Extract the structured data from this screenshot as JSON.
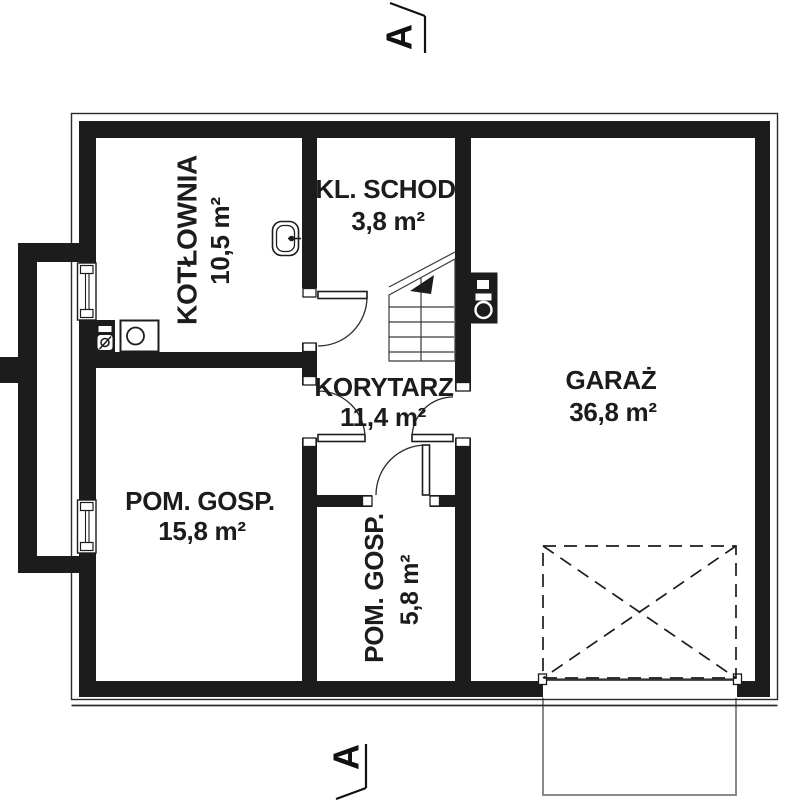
{
  "plan": {
    "type": "floor-plan",
    "section_marker": "A",
    "rooms": {
      "kotlownia": {
        "name": "KOTŁOWNIA",
        "area": "10,5 m²"
      },
      "kl_schod": {
        "name": "KL. SCHOD.",
        "area": "3,8 m²"
      },
      "korytarz": {
        "name": "KORYTARZ",
        "area": "11,4 m²"
      },
      "garaz": {
        "name": "GARAŻ",
        "area": "36,8 m²"
      },
      "pom_gosp_15": {
        "name": "POM. GOSP.",
        "area": "15,8 m²"
      },
      "pom_gosp_5": {
        "name": "POM. GOSP.",
        "area": "5,8 m²"
      }
    },
    "fixtures": [
      "sink",
      "boiler",
      "meter-panel",
      "water-heater",
      "stairs",
      "garage-door",
      "windows",
      "exterior-stairwell",
      "driveway-apron"
    ],
    "colors": {
      "wall": "#1c1c1c",
      "line": "#2b2b2b",
      "apron_outline": "#7d7d7d",
      "background": "#ffffff"
    }
  }
}
